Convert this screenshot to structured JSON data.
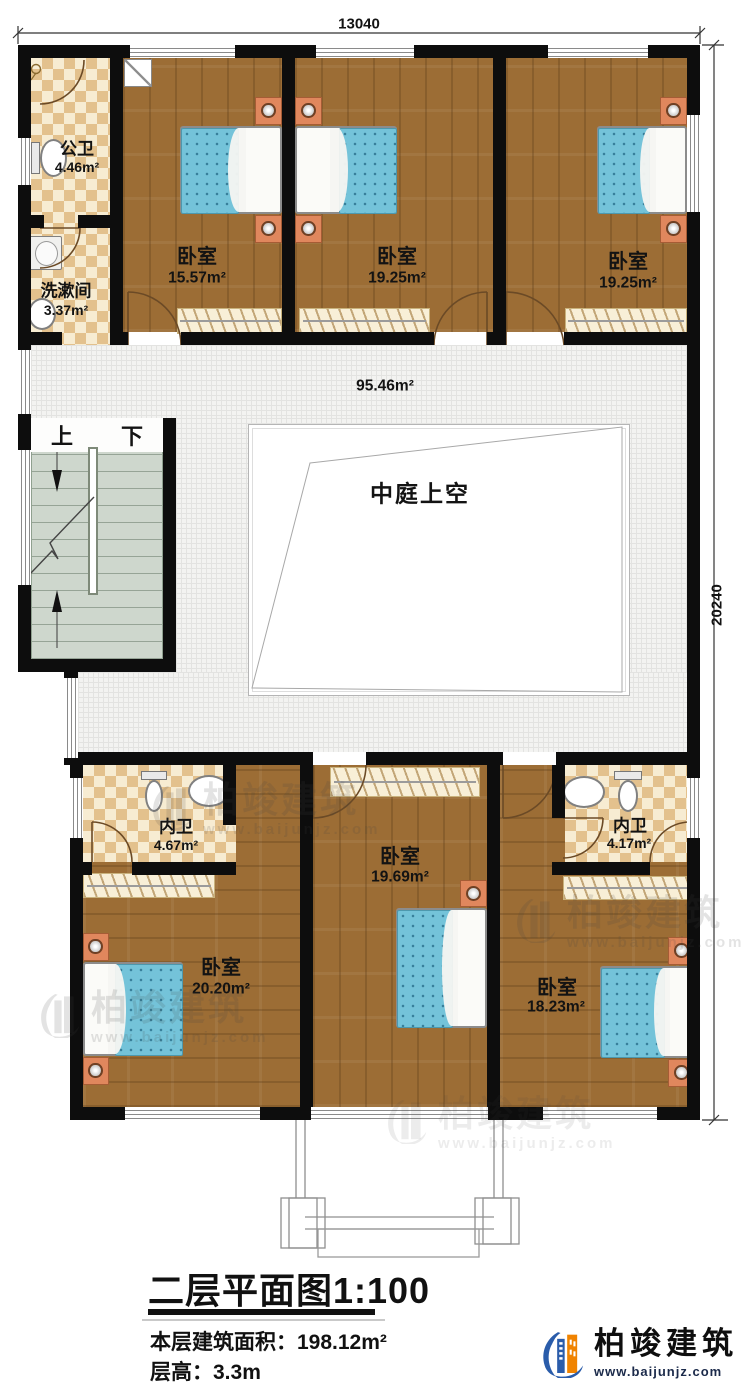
{
  "dimensions": {
    "top": "13040",
    "right": "20240"
  },
  "rooms": {
    "public_bath": {
      "name": "公卫",
      "area": "4.46m²"
    },
    "washroom": {
      "name": "洗漱间",
      "area": "3.37m²"
    },
    "bedroom_nw": {
      "name": "卧室",
      "area": "15.57m²"
    },
    "bedroom_n": {
      "name": "卧室",
      "area": "19.25m²"
    },
    "bedroom_ne": {
      "name": "卧室",
      "area": "19.25m²"
    },
    "hall": {
      "area": "95.46m²"
    },
    "atrium": {
      "name": "中庭上空"
    },
    "bath_sw": {
      "name": "内卫",
      "area": "4.67m²"
    },
    "bedroom_sw": {
      "name": "卧室",
      "area": "20.20m²"
    },
    "bedroom_s": {
      "name": "卧室",
      "area": "19.69m²"
    },
    "bath_se": {
      "name": "内卫",
      "area": "4.17m²"
    },
    "bedroom_se": {
      "name": "卧室",
      "area": "18.23m²"
    }
  },
  "stairs": {
    "up": "上",
    "down": "下"
  },
  "title_block": {
    "title": "二层平面图1:100",
    "area_line": "本层建筑面积：198.12m²",
    "height_line": "层高：3.3m"
  },
  "brand": {
    "name": "柏竣建筑",
    "url": "www.baijunjz.com"
  },
  "icons": {
    "brand_logo": "building-swoosh-logo-icon"
  },
  "colors": {
    "brand_blue": "#2a5caa",
    "brand_orange": "#f08300",
    "wood_floor": "#9c6d35",
    "tile_check": "#e3c18d",
    "mattress": "#74c3d9",
    "wall": "#0d0d0d"
  }
}
